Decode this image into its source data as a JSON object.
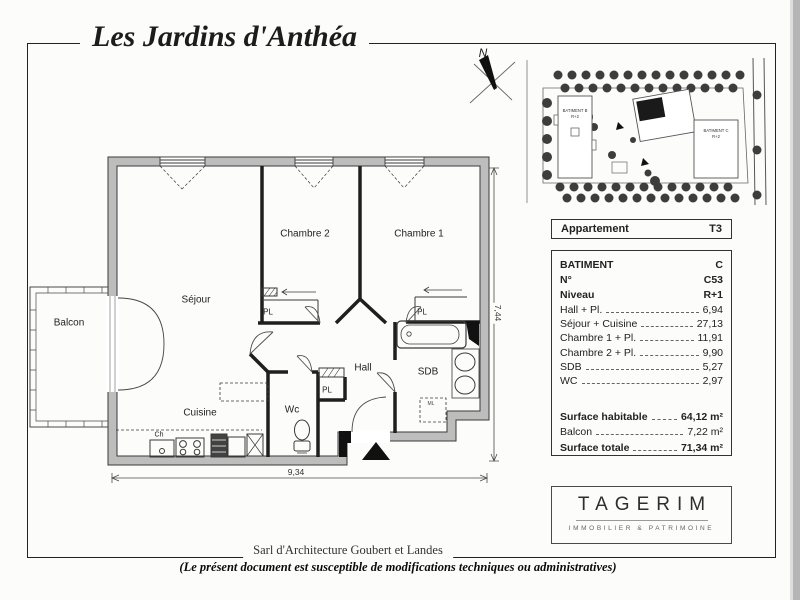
{
  "title": "Les Jardins d'Anthéa",
  "site_plan": {
    "north_label": "N",
    "building_b": "BATIMENT B",
    "building_b_level": "R+2",
    "building_c": "BATIMENT C",
    "building_c_level": "R+2"
  },
  "apartment_header": {
    "label": "Appartement",
    "value": "T3"
  },
  "details": {
    "rows": [
      {
        "label": "BATIMENT",
        "value": "C"
      },
      {
        "label": "N°",
        "value": "C53"
      },
      {
        "label": "Niveau",
        "value": "R+1"
      }
    ],
    "rooms": [
      {
        "label": "Hall + Pl.",
        "value": "6,94"
      },
      {
        "label": "Séjour + Cuisine",
        "value": "27,13"
      },
      {
        "label": "Chambre 1 + Pl.",
        "value": "11,91"
      },
      {
        "label": "Chambre 2 + Pl.",
        "value": "9,90"
      },
      {
        "label": "SDB",
        "value": "5,27"
      },
      {
        "label": "WC",
        "value": "2,97"
      }
    ],
    "totals": [
      {
        "label": "Surface habitable",
        "value": "64,12 m²"
      },
      {
        "label": "Balcon",
        "value": "7,22 m²"
      },
      {
        "label": "Surface totale",
        "value": "71,34 m²"
      }
    ]
  },
  "logo": {
    "name": "TAGERIM",
    "tagline": "IMMOBILIER & PATRIMOINE"
  },
  "footer": {
    "architect": "Sarl d'Architecture Goubert et Landes",
    "disclaimer": "(Le présent document est susceptible de modifications techniques ou administratives)"
  },
  "floor_plan": {
    "rooms": {
      "balcon": "Balcon",
      "sejour": "Séjour",
      "cuisine": "Cuisine",
      "chambre2": "Chambre 2",
      "chambre1": "Chambre 1",
      "hall": "Hall",
      "wc": "Wc",
      "sdb": "SDB"
    },
    "closet_label": "PL",
    "water_heater_label": "Ch",
    "washing_machine_label": "ML",
    "dim_width": "9,34",
    "dim_height": "7,44"
  }
}
